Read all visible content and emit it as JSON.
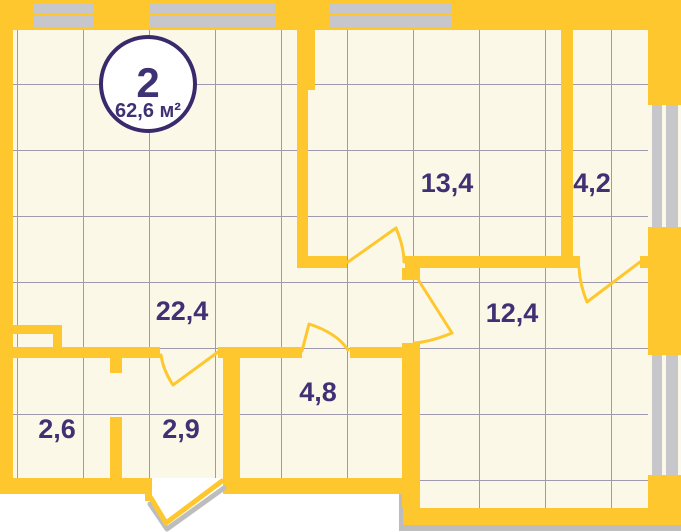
{
  "unit": {
    "number": "2",
    "area": "62,6 м²"
  },
  "rooms": [
    {
      "name": "room-13-4",
      "area": "13,4"
    },
    {
      "name": "room-4-2",
      "area": "4,2"
    },
    {
      "name": "hall-22-4",
      "area": "22,4"
    },
    {
      "name": "room-12-4",
      "area": "12,4"
    },
    {
      "name": "room-4-8",
      "area": "4,8"
    },
    {
      "name": "room-2-6",
      "area": "2,6"
    },
    {
      "name": "room-2-9",
      "area": "2,9"
    }
  ],
  "colors": {
    "wall": "#FFC72E",
    "floor": "#FCF8E7",
    "grid": "#8E89A5",
    "label": "#3F3173",
    "window": "#C7C6CA",
    "badge_border": "#392A6C",
    "shadow": "#BDBDBD"
  }
}
